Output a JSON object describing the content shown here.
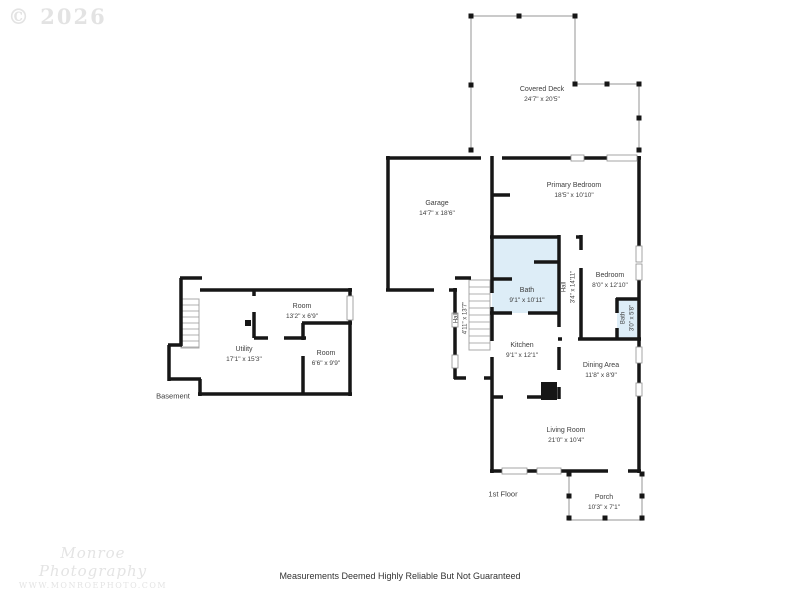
{
  "watermark": {
    "copyright": "© 2026",
    "studio": "Monroe Photography",
    "website": "WWW.MONROEPHOTO.COM"
  },
  "footer": {
    "disclaimer": "Measurements Deemed Highly Reliable But Not Guaranteed"
  },
  "floors": {
    "first": "1st Floor",
    "basement": "Basement"
  },
  "rooms": {
    "covered_deck": {
      "name": "Covered Deck",
      "dims": "24'7\" x 20'5\""
    },
    "garage": {
      "name": "Garage",
      "dims": "14'7\" x 18'6\""
    },
    "primary_bedroom": {
      "name": "Primary Bedroom",
      "dims": "18'5\" x 10'10\""
    },
    "bath_main": {
      "name": "Bath",
      "dims": "9'1\" x 10'11\""
    },
    "hall_bedroom": {
      "name": "Hall",
      "dims": "3'4\" x 14'11\""
    },
    "bedroom": {
      "name": "Bedroom",
      "dims": "8'0\" x 12'10\""
    },
    "bath_small": {
      "name": "Bath",
      "dims": "3'0\" x 5'8\""
    },
    "hall_stairs": {
      "name": "Hall",
      "dims": "4'11\" x 13'7\""
    },
    "kitchen": {
      "name": "Kitchen",
      "dims": "9'1\" x 12'1\""
    },
    "dining_area": {
      "name": "Dining Area",
      "dims": "11'8\" x 8'9\""
    },
    "living_room": {
      "name": "Living Room",
      "dims": "21'0\" x 10'4\""
    },
    "porch": {
      "name": "Porch",
      "dims": "10'3\" x 7'1\""
    },
    "basement_room_upper": {
      "name": "Room",
      "dims": "13'2\" x 6'9\""
    },
    "utility": {
      "name": "Utility",
      "dims": "17'1\" x 15'3\""
    },
    "basement_room_lower": {
      "name": "Room",
      "dims": "6'6\" x 9'9\""
    }
  },
  "colors": {
    "wall": "#161616",
    "bath_fill": "#ddedf7",
    "deck_outline": "#b9b9b9",
    "label_text": "#3d3d3d",
    "watermark": "#e3e3e3"
  }
}
